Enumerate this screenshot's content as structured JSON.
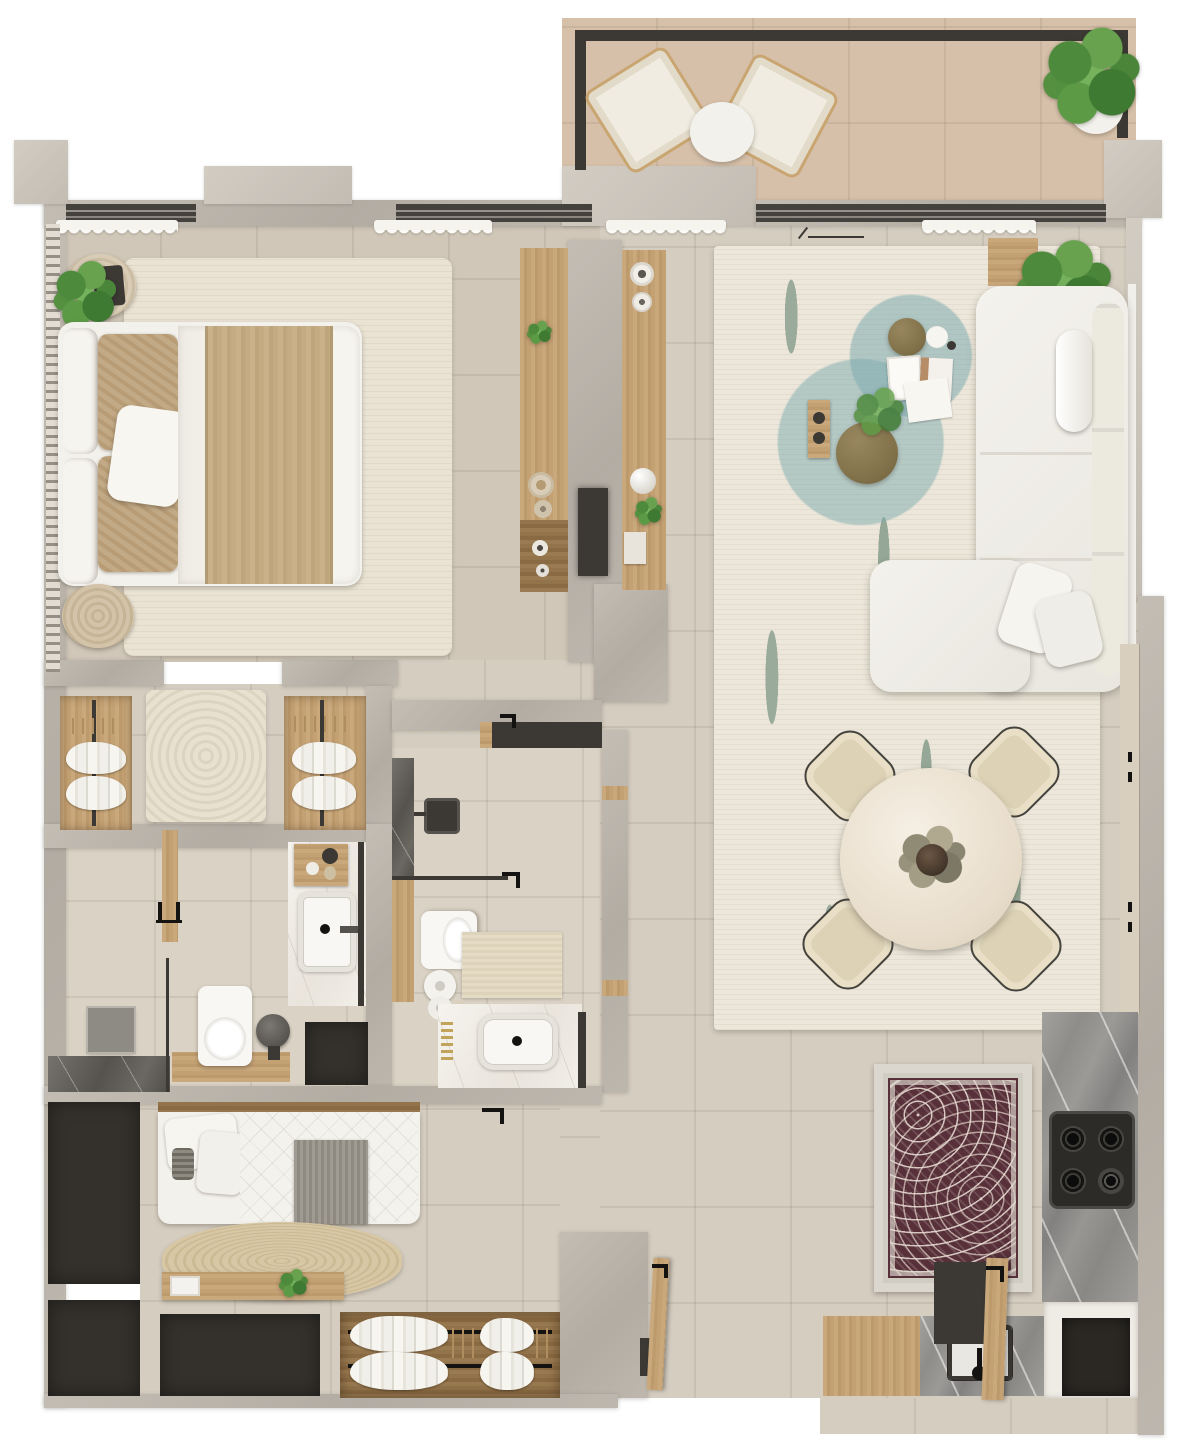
{
  "meta": {
    "kind": "apartment-floor-plan-3d-render",
    "view": "top-down",
    "visible_text": "none",
    "rooms_count": 8
  },
  "palette": {
    "page_bg": "#ffffff",
    "wall": "#b8b2a9",
    "floor": "#d5cdc0",
    "balcony_floor": "#d7c0a9",
    "wood": "#c4a173",
    "dark_frame": "#3c3935",
    "charcoal_block": "#34312c",
    "white_furniture": "#f3f1ec",
    "cream_rug": "#eae3d4",
    "teal_accent": "#7daaaf",
    "sage_accent": "#9aab9b",
    "olive_table": "#7f6f48",
    "maroon_rug": "#57303a",
    "jute_rug": "#d2c09c",
    "plant_green": "#5d9a45",
    "marble_grey": "#8f8d8a"
  },
  "rooms": [
    {
      "name": "balcony",
      "furniture": [
        "lounge-chair",
        "lounge-chair",
        "round-side-table",
        "potted-plant",
        "dark-railing"
      ]
    },
    {
      "name": "master-bedroom",
      "furniture": [
        "double-bed",
        "white-pillows",
        "tan-accent-pillows",
        "tan-throw-blanket",
        "cream-area-rug",
        "round-rattan-nightstand",
        "tablet",
        "potted-plant",
        "wood-stool",
        "radiator-louver",
        "curtained-windows"
      ]
    },
    {
      "name": "tv-partition-wall",
      "furniture": [
        "media-console-bedroom-side",
        "display-console-living-side",
        "wall-mounted-tv",
        "decor-vases",
        "decor-plates",
        "small-plants"
      ]
    },
    {
      "name": "walk-in-closet",
      "furniture": [
        "open-wardrobe",
        "open-wardrobe",
        "hanging-white-clothes",
        "zen-textured-rug"
      ]
    },
    {
      "name": "master-bathroom",
      "furniture": [
        "dark-marble-shower-floor",
        "shower-bench",
        "shower-valves",
        "glass-screen",
        "wall-hung-toilet",
        "waste-bin",
        "marble-vanity",
        "white-basin",
        "black-faucet",
        "toiletries-tray",
        "dark-mat"
      ]
    },
    {
      "name": "second-bathroom",
      "furniture": [
        "rain-shower-head",
        "dark-marble-shower-wall",
        "glass-screen",
        "wall-hung-toilet",
        "textured-bath-mat",
        "rolled-towels",
        "vanity-counter",
        "vessel-basin",
        "black-faucet",
        "entry-bench"
      ]
    },
    {
      "name": "second-bedroom",
      "furniture": [
        "single-bed",
        "white-pillows",
        "grey-throw",
        "oval-jute-rug",
        "wood-desk-console",
        "laptop",
        "potted-plant",
        "open-wardrobe",
        "hanging-white-clothes",
        "charcoal-storage-block",
        "charcoal-storage-block",
        "charcoal-storage-block",
        "interior-door"
      ]
    },
    {
      "name": "living-room",
      "furniture": [
        "l-shaped-sectional-sofa",
        "bolster-cushion",
        "throw-pillows",
        "patterned-area-rug",
        "olive-coffee-table-large",
        "olive-coffee-table-small",
        "white-side-dish",
        "magazines",
        "wood-tray-with-remotes",
        "flower-sprig",
        "potted-plant",
        "wood-sideboard",
        "door-swing-mark",
        "curtained-windows"
      ]
    },
    {
      "name": "dining-area",
      "furniture": [
        "round-marble-table",
        "dried-flower-centerpiece",
        "dining-chair",
        "dining-chair",
        "dining-chair",
        "dining-chair"
      ]
    },
    {
      "name": "kitchen",
      "furniture": [
        "grey-marble-counter-right",
        "grey-marble-counter-bottom",
        "gas-hob-4-burner",
        "square-sink",
        "black-faucet",
        "wood-cutting-board",
        "built-in-dark-appliance",
        "tall-cabinet-row",
        "oriental-maroon-rug"
      ]
    },
    {
      "name": "entry",
      "furniture": [
        "open-entry-door",
        "black-door-handle",
        "doorway-opening"
      ]
    }
  ],
  "counts": {
    "windows": 3,
    "doors_visible": 2,
    "dining_chairs": 4,
    "hob_burners": 4,
    "wardrobes": 3
  }
}
